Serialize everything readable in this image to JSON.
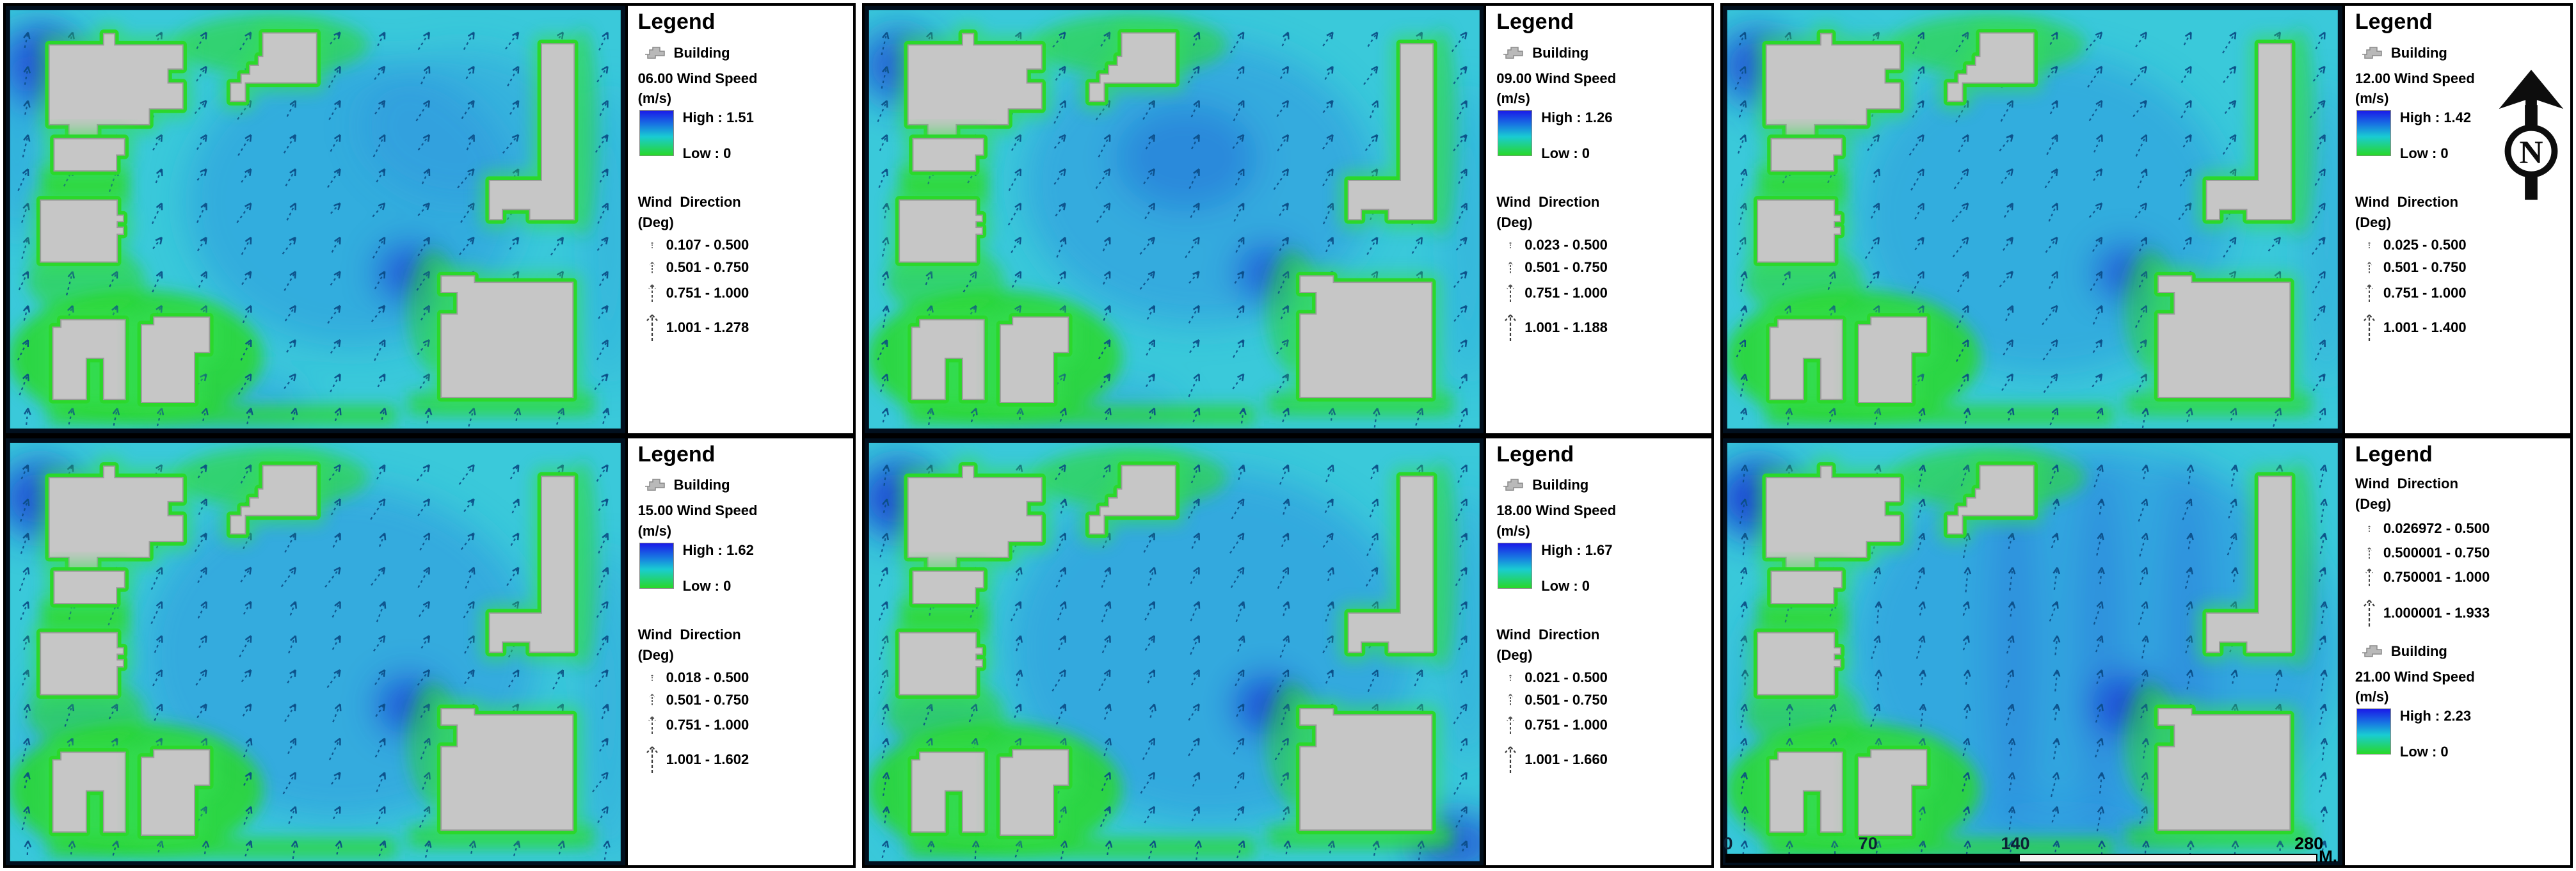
{
  "legend_title": "Legend",
  "scale_bar": {
    "ticks": [
      "0",
      "70",
      "140",
      "280"
    ],
    "unit_label": "M."
  },
  "north_label": "N",
  "colors": {
    "water_cyan": "#3ac9da",
    "flow_blue": "#2d92e2",
    "deep_blue": "#1b3bd4",
    "building_gray": "#c6c6c6",
    "halo_green": "#2bd82b",
    "arrow_navy": "#0a4a84",
    "ramp_top_blue": "#1a1ae8",
    "ramp_bottom_green": "#28d828"
  },
  "panels": [
    {
      "time": "06:00",
      "building_label": "Building",
      "speed_label": "06.00 Wind Speed",
      "unit_label": "(m/s)",
      "high_label": "High : 1.51",
      "low_label": "Low : 0",
      "direction_label": "Wind  Direction",
      "deg_label": "(Deg)",
      "ranges": [
        "0.107 - 0.500",
        "0.501 - 0.750",
        "0.751 - 1.000",
        "1.001 - 1.278"
      ],
      "direction_first": false,
      "has_north_arrow": false,
      "has_scale_bar": false
    },
    {
      "time": "09:00",
      "building_label": "Building",
      "speed_label": "09.00 Wind Speed",
      "unit_label": "(m/s)",
      "high_label": "High : 1.26",
      "low_label": "Low : 0",
      "direction_label": "Wind  Direction",
      "deg_label": "(Deg)",
      "ranges": [
        "0.023 - 0.500",
        "0.501 - 0.750",
        "0.751 - 1.000",
        "1.001 - 1.188"
      ],
      "direction_first": false,
      "has_north_arrow": false,
      "has_scale_bar": false
    },
    {
      "time": "12:00",
      "building_label": "Building",
      "speed_label": "12.00 Wind Speed",
      "unit_label": "(m/s)",
      "high_label": "High : 1.42",
      "low_label": "Low : 0",
      "direction_label": "Wind  Direction",
      "deg_label": "(Deg)",
      "ranges": [
        "0.025 - 0.500",
        "0.501 - 0.750",
        "0.751 - 1.000",
        "1.001 - 1.400"
      ],
      "direction_first": false,
      "has_north_arrow": true,
      "has_scale_bar": false
    },
    {
      "time": "15:00",
      "building_label": "Building",
      "speed_label": "15.00 Wind Speed",
      "unit_label": "(m/s)",
      "high_label": "High : 1.62",
      "low_label": "Low : 0",
      "direction_label": "Wind  Direction",
      "deg_label": "(Deg)",
      "ranges": [
        "0.018 - 0.500",
        "0.501 - 0.750",
        "0.751 - 1.000",
        "1.001 - 1.602"
      ],
      "direction_first": false,
      "has_north_arrow": false,
      "has_scale_bar": false
    },
    {
      "time": "18:00",
      "building_label": "Building",
      "speed_label": "18.00 Wind Speed",
      "unit_label": "(m/s)",
      "high_label": "High : 1.67",
      "low_label": "Low : 0",
      "direction_label": "Wind  Direction",
      "deg_label": "(Deg)",
      "ranges": [
        "0.021 - 0.500",
        "0.501 - 0.750",
        "0.751 - 1.000",
        "1.001 - 1.660"
      ],
      "direction_first": false,
      "has_north_arrow": false,
      "has_scale_bar": false
    },
    {
      "time": "21:00",
      "building_label": "Building",
      "speed_label": "21.00 Wind Speed",
      "unit_label": "(m/s)",
      "high_label": "High : 2.23",
      "low_label": "Low : 0",
      "direction_label": "Wind  Direction",
      "deg_label": "(Deg)",
      "ranges": [
        "0.026972 - 0.500",
        "0.500001 - 0.750",
        "0.750001 - 1.000",
        "1.000001 - 1.933"
      ],
      "direction_first": true,
      "has_north_arrow": false,
      "has_scale_bar": true
    }
  ],
  "chart_data": {
    "type": "heatmap",
    "subtype": "urban-wind-field-vector-maps",
    "grid": "2 rows x 3 columns",
    "legend_position": "right side of each panel",
    "orientation": "north-up",
    "scale_bar_meters": [
      0,
      70,
      140,
      280
    ],
    "scale_bar_unit": "M",
    "colormap": {
      "high_color": "blue",
      "low_color": "green",
      "label": "Wind Speed (m/s)"
    },
    "panels": [
      {
        "time": "06:00",
        "wind_speed_ms": {
          "high": 1.51,
          "low": 0
        },
        "wind_direction_deg_bins": [
          [
            0.107,
            0.5
          ],
          [
            0.501,
            0.75
          ],
          [
            0.751,
            1.0
          ],
          [
            1.001,
            1.278
          ]
        ]
      },
      {
        "time": "09:00",
        "wind_speed_ms": {
          "high": 1.26,
          "low": 0
        },
        "wind_direction_deg_bins": [
          [
            0.023,
            0.5
          ],
          [
            0.501,
            0.75
          ],
          [
            0.751,
            1.0
          ],
          [
            1.001,
            1.188
          ]
        ]
      },
      {
        "time": "12:00",
        "wind_speed_ms": {
          "high": 1.42,
          "low": 0
        },
        "wind_direction_deg_bins": [
          [
            0.025,
            0.5
          ],
          [
            0.501,
            0.75
          ],
          [
            0.751,
            1.0
          ],
          [
            1.001,
            1.4
          ]
        ]
      },
      {
        "time": "15:00",
        "wind_speed_ms": {
          "high": 1.62,
          "low": 0
        },
        "wind_direction_deg_bins": [
          [
            0.018,
            0.5
          ],
          [
            0.501,
            0.75
          ],
          [
            0.751,
            1.0
          ],
          [
            1.001,
            1.602
          ]
        ]
      },
      {
        "time": "18:00",
        "wind_speed_ms": {
          "high": 1.67,
          "low": 0
        },
        "wind_direction_deg_bins": [
          [
            0.021,
            0.5
          ],
          [
            0.501,
            0.75
          ],
          [
            0.751,
            1.0
          ],
          [
            1.001,
            1.66
          ]
        ]
      },
      {
        "time": "21:00",
        "wind_speed_ms": {
          "high": 2.23,
          "low": 0
        },
        "wind_direction_deg_bins": [
          [
            0.026972,
            0.5
          ],
          [
            0.500001,
            0.75
          ],
          [
            0.750001,
            1.0
          ],
          [
            1.000001,
            1.933
          ]
        ]
      }
    ]
  }
}
